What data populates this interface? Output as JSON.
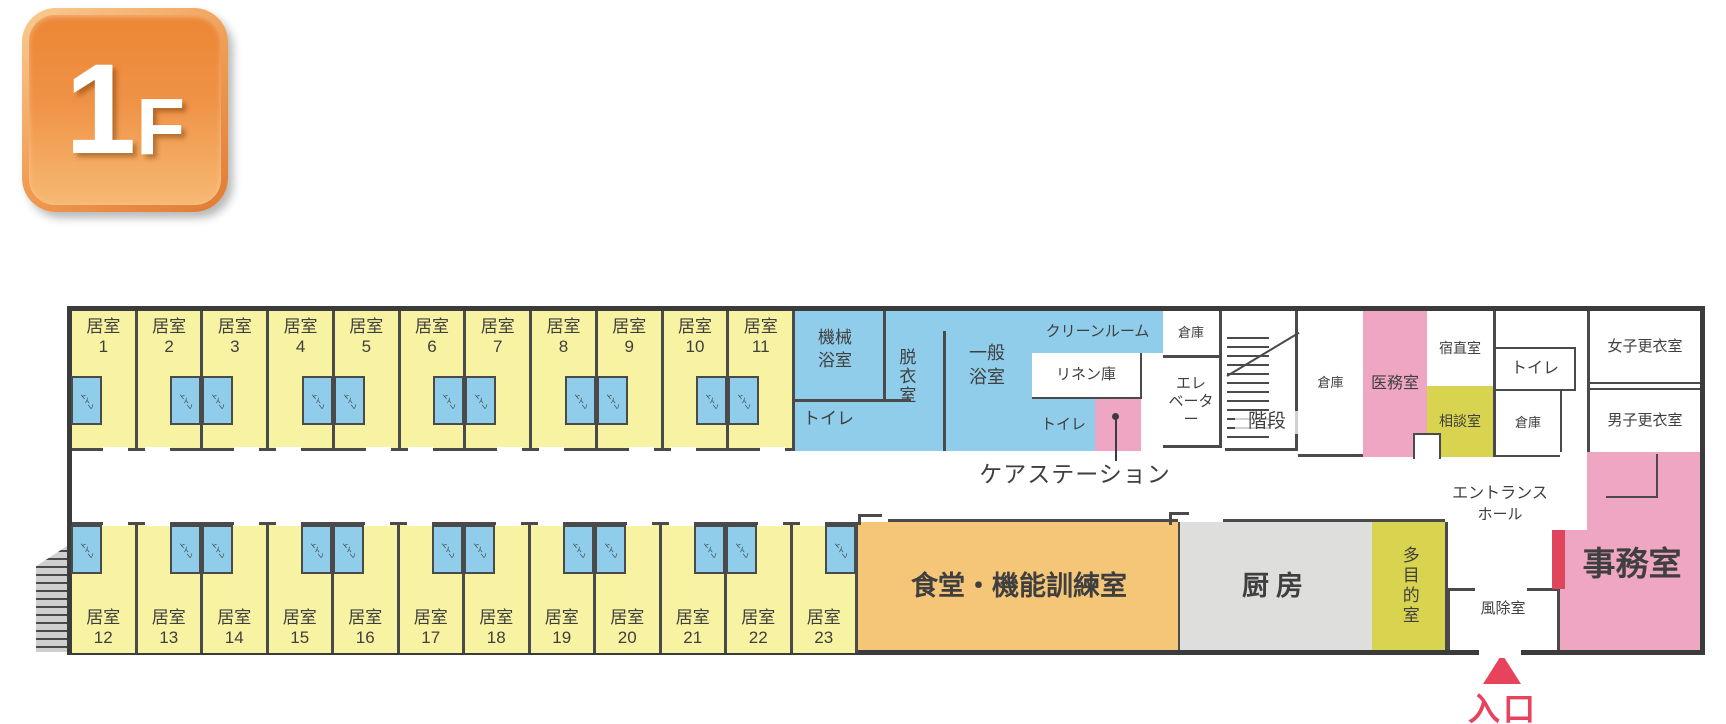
{
  "floor_badge": {
    "number": "1",
    "suffix": "F"
  },
  "colors": {
    "room_yellow": "#F8F3A3",
    "wet_area_blue": "#8FCDEA",
    "pink": "#EFA6C2",
    "dining_orange": "#F5C678",
    "kitchen_gray": "#DEDEDD",
    "yellow_green": "#D9D44F",
    "wall_dark": "#3b3b3b",
    "entrance_red": "#E8435C",
    "badge_orange": "#EC8634"
  },
  "rooms": {
    "label": "居室",
    "toilet": "トイレ",
    "upper": [
      {
        "num": "1",
        "toilet_side": "left"
      },
      {
        "num": "2",
        "toilet_side": "right"
      },
      {
        "num": "3",
        "toilet_side": "left"
      },
      {
        "num": "4",
        "toilet_side": "right"
      },
      {
        "num": "5",
        "toilet_side": "left"
      },
      {
        "num": "6",
        "toilet_side": "right"
      },
      {
        "num": "7",
        "toilet_side": "left"
      },
      {
        "num": "8",
        "toilet_side": "right"
      },
      {
        "num": "9",
        "toilet_side": "left"
      },
      {
        "num": "10",
        "toilet_side": "right"
      },
      {
        "num": "11",
        "toilet_side": "left"
      }
    ],
    "lower": [
      {
        "num": "12",
        "toilet_side": "left"
      },
      {
        "num": "13",
        "toilet_side": "right"
      },
      {
        "num": "14",
        "toilet_side": "left"
      },
      {
        "num": "15",
        "toilet_side": "right"
      },
      {
        "num": "16",
        "toilet_side": "left"
      },
      {
        "num": "17",
        "toilet_side": "right"
      },
      {
        "num": "18",
        "toilet_side": "left"
      },
      {
        "num": "19",
        "toilet_side": "right"
      },
      {
        "num": "20",
        "toilet_side": "left"
      },
      {
        "num": "21",
        "toilet_side": "right"
      },
      {
        "num": "22",
        "toilet_side": "left"
      },
      {
        "num": "23",
        "toilet_side": "right"
      }
    ]
  },
  "areas": {
    "machine_bath": "機械浴室",
    "undressing": "脱衣室",
    "general_bath": "一般浴室",
    "bath_toilet": "トイレ",
    "clean_room": "クリーンルーム",
    "linen_storage": "リネン庫",
    "corridor_toilet": "トイレ",
    "care_station": "ケアステーション",
    "storage_1": "倉庫",
    "elevator_line1": "エレ",
    "elevator_line2": "ベーター",
    "stairs": "階段",
    "storage_2": "倉庫",
    "medical_room": "医務室",
    "night_duty_room": "宿直室",
    "consultation_room": "相談室",
    "back_toilet": "トイレ",
    "storage_3": "倉庫",
    "womens_locker": "女子更衣室",
    "mens_locker": "男子更衣室",
    "office": "事務室",
    "entrance_hall_line1": "エントランス",
    "entrance_hall_line2": "ホール",
    "windbreak_room": "風除室",
    "dining_training": "食堂・機能訓練室",
    "kitchen": "厨房",
    "multipurpose": "多目的室",
    "entrance": "入口"
  }
}
